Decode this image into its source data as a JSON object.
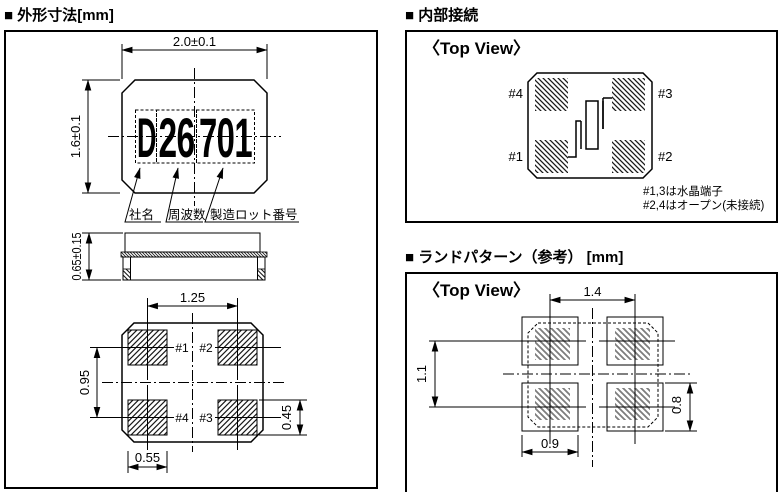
{
  "panels": {
    "outline": {
      "title": "■ 外形寸法[mm]",
      "dims": {
        "body_width": "2.0±0.1",
        "body_height": "1.6±0.1",
        "thickness": "0.65±0.15",
        "pad_pitch_x": "1.25",
        "pad_pitch_y": "0.95",
        "pad_height": "0.45",
        "pad_width": "0.55"
      },
      "marking": {
        "company": "D",
        "frequency": "26",
        "lot": "701"
      },
      "marking_labels": {
        "company": "社名",
        "frequency": "周波数",
        "lot": "製造ロット番号"
      },
      "pads": {
        "p1": "#1",
        "p2": "#2",
        "p3": "#3",
        "p4": "#4"
      }
    },
    "internal": {
      "title": "■ 内部接続",
      "view_label": "〈Top View〉",
      "pads": {
        "p1": "#1",
        "p2": "#2",
        "p3": "#3",
        "p4": "#4"
      },
      "notes": [
        "#1,3は水晶端子",
        "#2,4はオープン(未接続)"
      ]
    },
    "land": {
      "title": "■ ランドパターン（参考） [mm]",
      "view_label": "〈Top View〉",
      "dims": {
        "pitch_x": "1.4",
        "pitch_y": "1.1",
        "land_width": "0.9",
        "land_height": "0.8"
      }
    }
  }
}
